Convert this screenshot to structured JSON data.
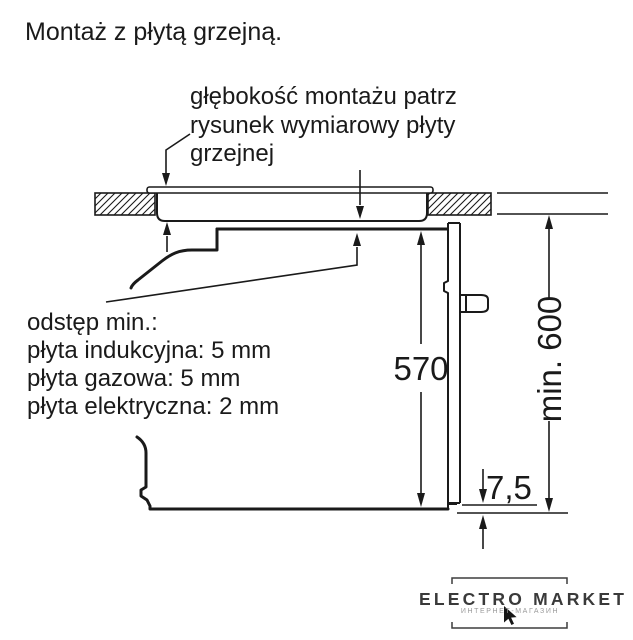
{
  "title": "Montaż z płytą grzejną.",
  "depth_note": {
    "line1": "głębokość montażu patrz",
    "line2": "rysunek wymiarowy płyty",
    "line3": "grzejnej"
  },
  "clearance_note": {
    "heading": "odstęp min.:",
    "induction": "płyta indukcyjna: 5 mm",
    "gas": "płyta gazowa: 5 mm",
    "electric": "płyta elektryczna: 2 mm"
  },
  "dimensions": {
    "oven_height_mm": "570",
    "niche_min_height": "min. 600",
    "bottom_gap_mm": "7,5"
  },
  "watermark": {
    "brand": "ELECTRO MARKET",
    "subtitle": "ИНТЕРНЕТ-МАГАЗИН"
  },
  "colors": {
    "ink": "#1a1a1a",
    "background": "#ffffff",
    "watermark": "#3a3a3a",
    "watermark_subtitle": "#9a9a9a"
  }
}
